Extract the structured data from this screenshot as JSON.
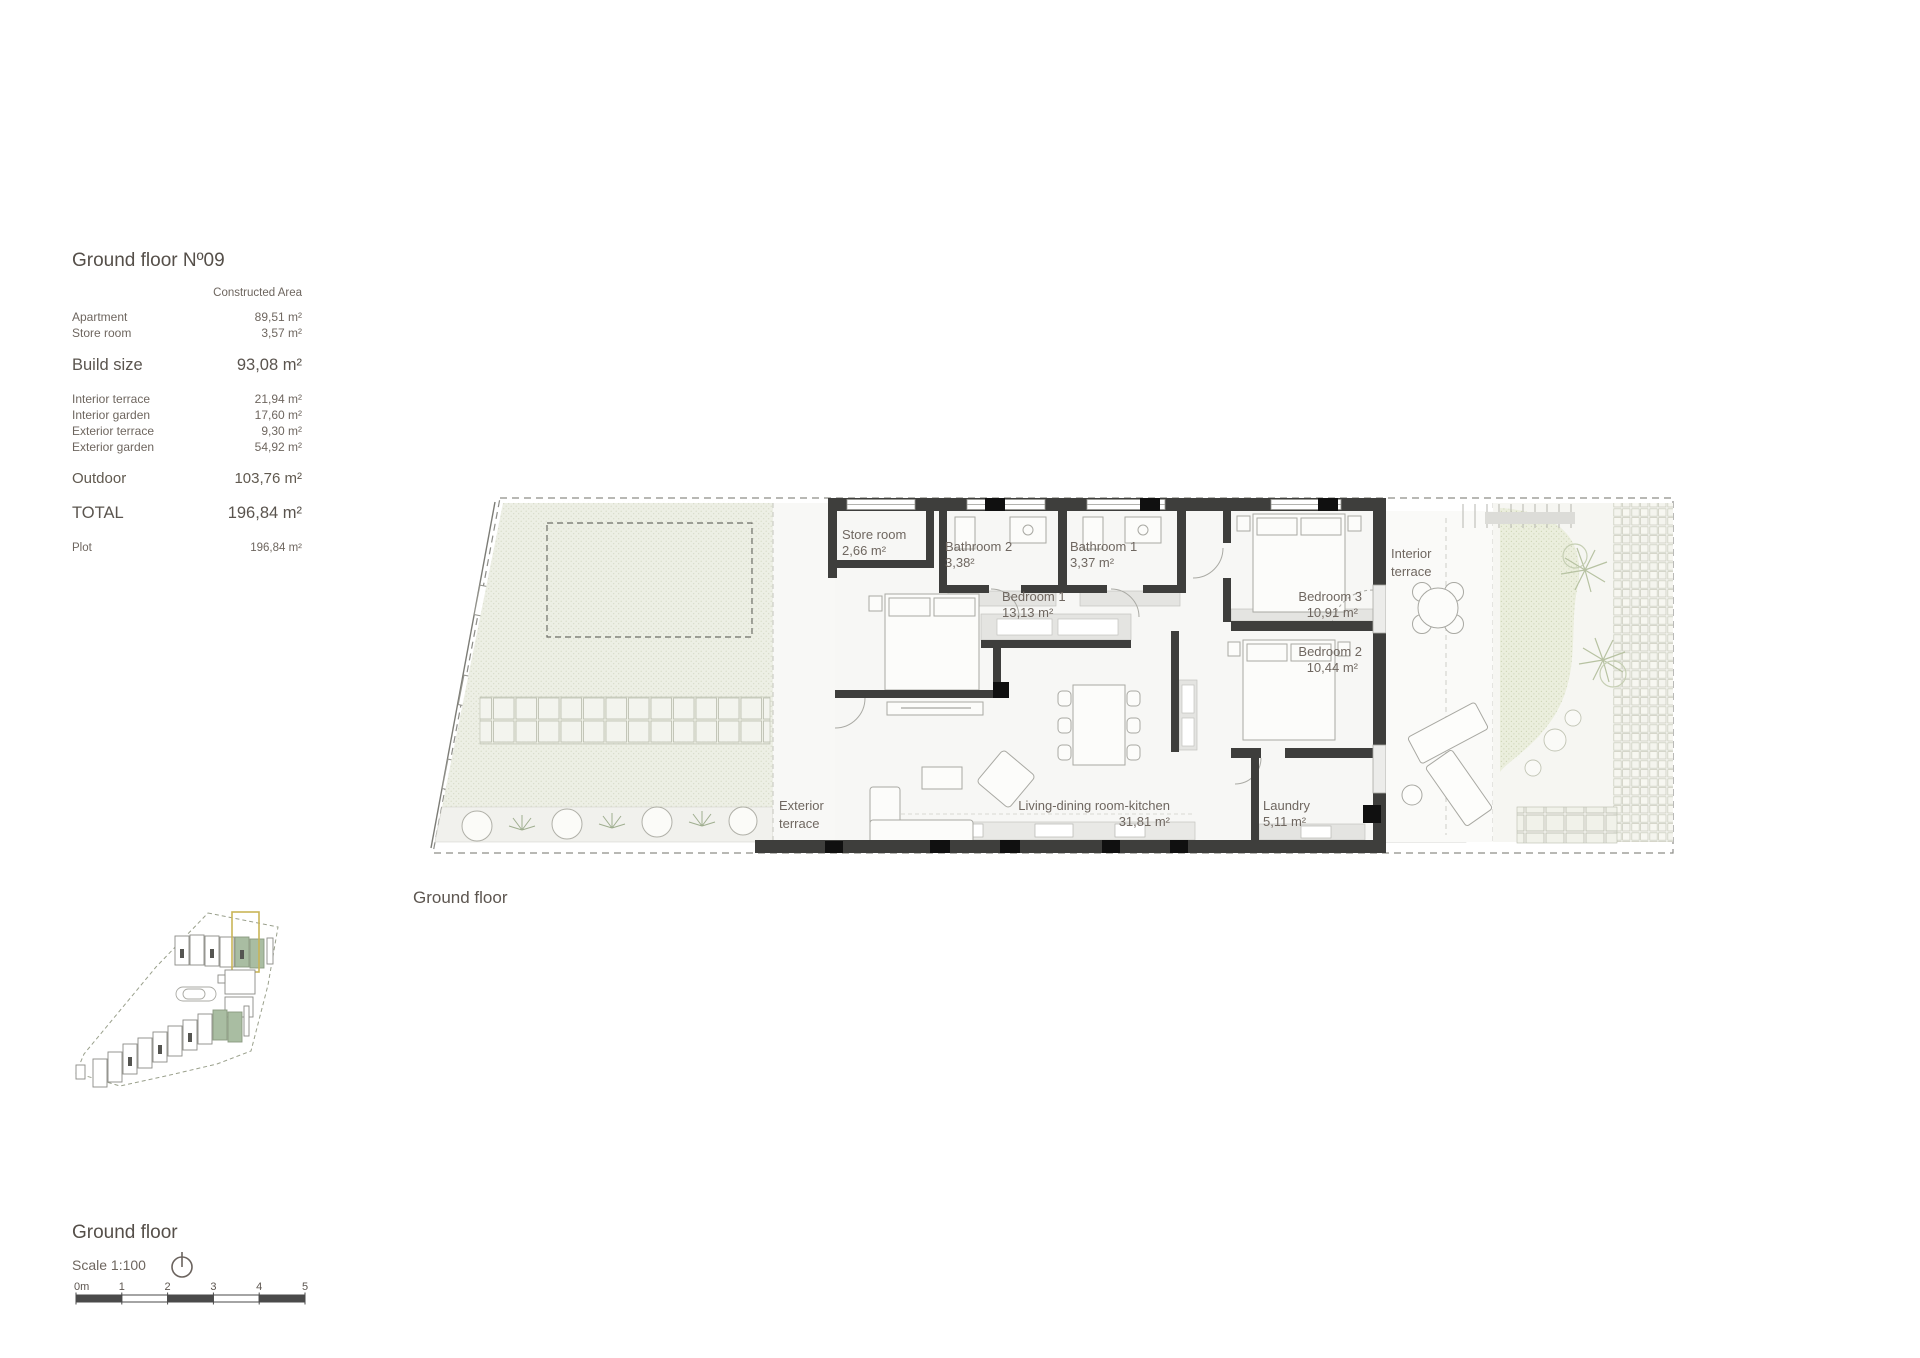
{
  "info_panel": {
    "title": "Ground floor Nº09",
    "column_header": "Constructed Area",
    "constructed_rows": [
      {
        "label": "Apartment",
        "value": "89,51 m²"
      },
      {
        "label": "Store room",
        "value": "3,57 m²"
      }
    ],
    "build_size": {
      "label": "Build size",
      "value": "93,08 m²"
    },
    "outdoor_rows": [
      {
        "label": "Interior terrace",
        "value": "21,94 m²"
      },
      {
        "label": "Interior garden",
        "value": "17,60 m²"
      },
      {
        "label": "Exterior terrace",
        "value": "9,30 m²"
      },
      {
        "label": "Exterior garden",
        "value": "54,92 m²"
      }
    ],
    "outdoor_total": {
      "label": "Outdoor",
      "value": "103,76 m²"
    },
    "total": {
      "label": "TOTAL",
      "value": "196,84 m²"
    },
    "plot": {
      "label": "Plot",
      "value": "196,84 m²"
    }
  },
  "floor_plan": {
    "caption": "Ground floor",
    "rooms": [
      {
        "name": "Store room",
        "area": "2,66 m²"
      },
      {
        "name": "Bathroom 2",
        "area": "3,38²"
      },
      {
        "name": "Bathroom 1",
        "area": "3,37 m²"
      },
      {
        "name": "Bedroom 1",
        "area": "13,13 m²"
      },
      {
        "name": "Bedroom 3",
        "area": "10,91 m²"
      },
      {
        "name": "Bedroom 2",
        "area": "10,44 m²"
      },
      {
        "name": "Living-dining room-kitchen",
        "area": "31,81 m²"
      },
      {
        "name": "Laundry",
        "area": "5,11 m²"
      }
    ],
    "zones": {
      "exterior_terrace_line1": "Exterior",
      "exterior_terrace_line2": "terrace",
      "interior_terrace_line1": "Interior",
      "interior_terrace_line2": "terrace"
    }
  },
  "footer": {
    "title": "Ground floor",
    "scale_label": "Scale 1:100",
    "scale_ticks": [
      "0m",
      "1",
      "2",
      "3",
      "4",
      "5"
    ]
  },
  "colors": {
    "wall": "#3e3e3c",
    "column_black": "#101010",
    "text": "#6e665f",
    "garden_fill": "#edefe5",
    "minimap_unit_green": "#a9bda2",
    "minimap_highlight_yellow": "#c9b557",
    "scale_bar_dark": "#4a4a4a"
  }
}
